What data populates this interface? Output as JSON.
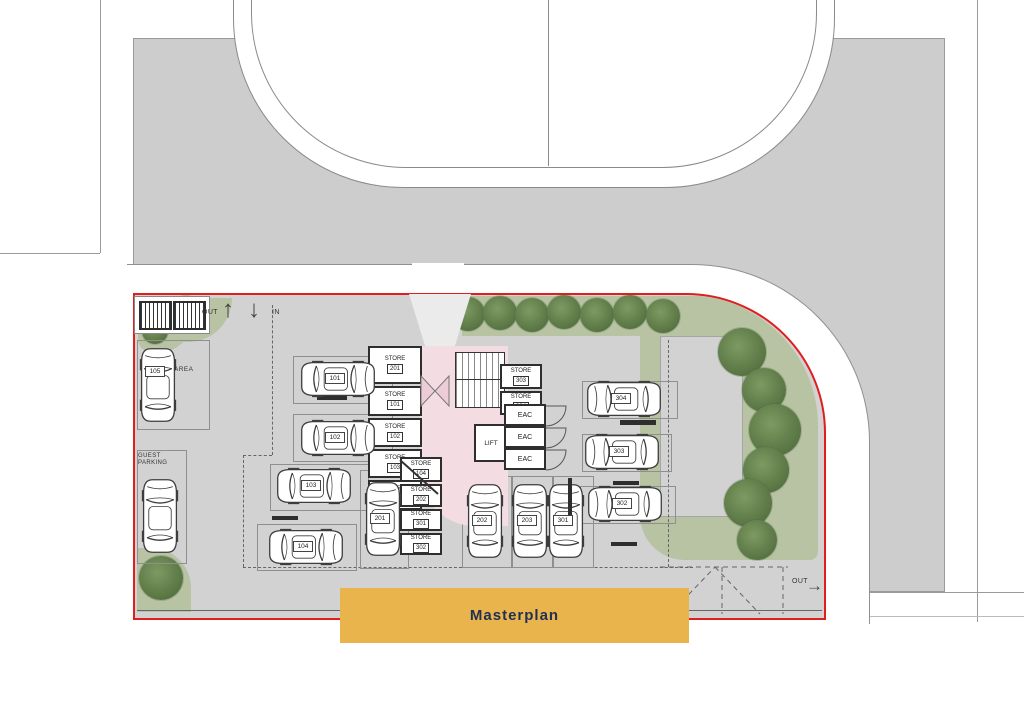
{
  "banner": {
    "label": "Masterplan",
    "bg": "#E9B44C",
    "text_color": "#233054"
  },
  "colors": {
    "boundary_red": "#E01E1E",
    "road_gray": "#CDCDCD",
    "site_gray": "#D2D2D2",
    "landscape_green": "#B7C3A3",
    "tree_green": "#5D7A47",
    "lobby_pink": "#F3DCE2"
  },
  "circulation": {
    "entry_out": "OUT",
    "entry_in": "IN",
    "exit_out": "OUT"
  },
  "labels": {
    "area": "AREA",
    "guest": "GUEST PARKING",
    "lift": "LIFT",
    "eac": "EAC",
    "store": "STORE"
  },
  "parking": {
    "spaces": [
      "105",
      "101",
      "102",
      "103",
      "104",
      "201",
      "202",
      "203",
      "301",
      "302",
      "303",
      "304"
    ]
  },
  "stores": {
    "left": [
      "201",
      "101",
      "102",
      "103",
      "203"
    ],
    "bottom": [
      "104",
      "202",
      "301",
      "302"
    ],
    "right": [
      "303",
      "304"
    ]
  }
}
